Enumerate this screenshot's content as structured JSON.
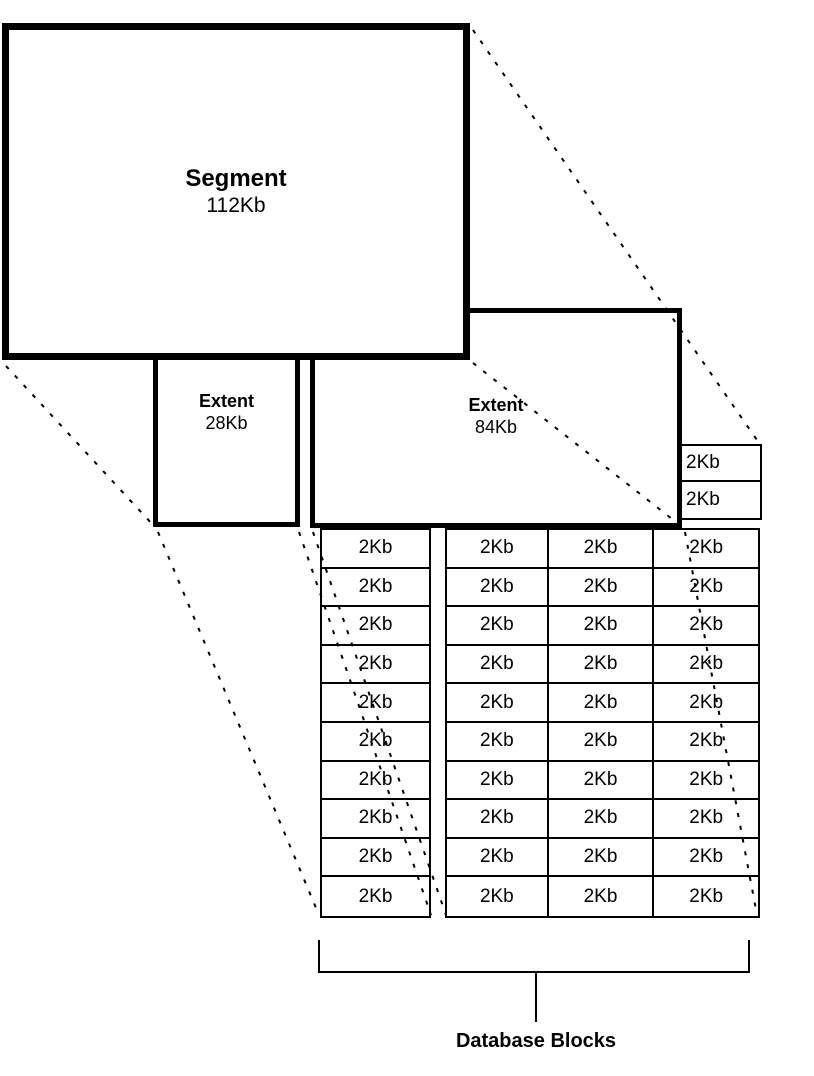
{
  "diagram": {
    "segment": {
      "label": "Segment",
      "size": "112Kb"
    },
    "extent_small": {
      "label": "Extent",
      "size": "28Kb"
    },
    "extent_large": {
      "label": "Extent",
      "size": "84Kb"
    },
    "block_label": "2Kb",
    "overflow_cells": {
      "count": 2
    },
    "left_block_column": {
      "rows": 10,
      "cols": 1
    },
    "right_block_grid": {
      "rows": 10,
      "cols": 3
    },
    "caption": "Database Blocks",
    "colors": {
      "line": "#000000",
      "background": "#ffffff"
    }
  }
}
